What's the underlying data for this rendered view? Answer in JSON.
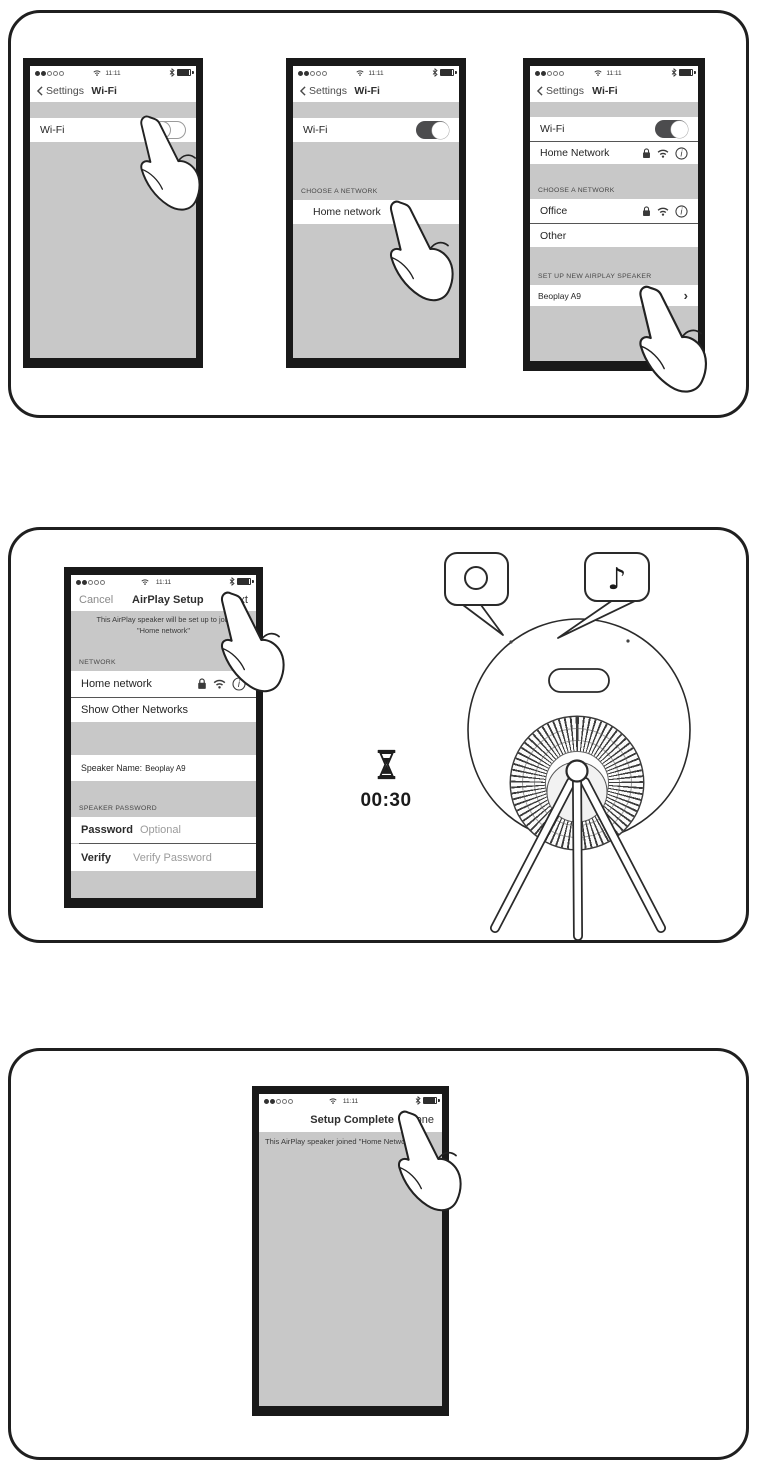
{
  "status": {
    "time": "11:11"
  },
  "common": {
    "back": "Settings",
    "wifi_title": "Wi-Fi"
  },
  "phone1": {
    "wifi_label": "Wi-Fi"
  },
  "phone2": {
    "wifi_label": "Wi-Fi",
    "choose_section": "CHOOSE A NETWORK",
    "home_network": "Home network"
  },
  "phone3": {
    "wifi_label": "Wi-Fi",
    "home_network": "Home Network",
    "choose_section": "CHOOSE A NETWORK",
    "office": "Office",
    "other": "Other",
    "setup_section": "SET UP NEW AIRPLAY SPEAKER",
    "speaker": "Beoplay A9",
    "chevron": "›"
  },
  "phone4": {
    "cancel": "Cancel",
    "title": "AirPlay Setup",
    "next": "Next",
    "message_line1": "This AirPlay speaker will be set up to join",
    "message_line2": "\"Home network\"",
    "network_section": "NETWORK",
    "home_network": "Home network",
    "show_other": "Show Other Networks",
    "speaker_name_label": "Speaker Name:",
    "speaker_name_value": "Beoplay A9",
    "password_section": "SPEAKER PASSWORD",
    "password_label": "Password",
    "password_placeholder": "Optional",
    "verify_label": "Verify",
    "verify_placeholder": "Verify Password"
  },
  "timer": {
    "value": "00:30"
  },
  "phone5": {
    "title": "Setup Complete",
    "done": "Done",
    "message": "This AirPlay speaker joined \"Home Network\""
  },
  "speaker_callouts": {
    "note_icon": "♪"
  },
  "colors": {
    "screen_gray": "#c8c8c8",
    "frame_black": "#191919",
    "toggle_on": "#4c4c4e"
  }
}
